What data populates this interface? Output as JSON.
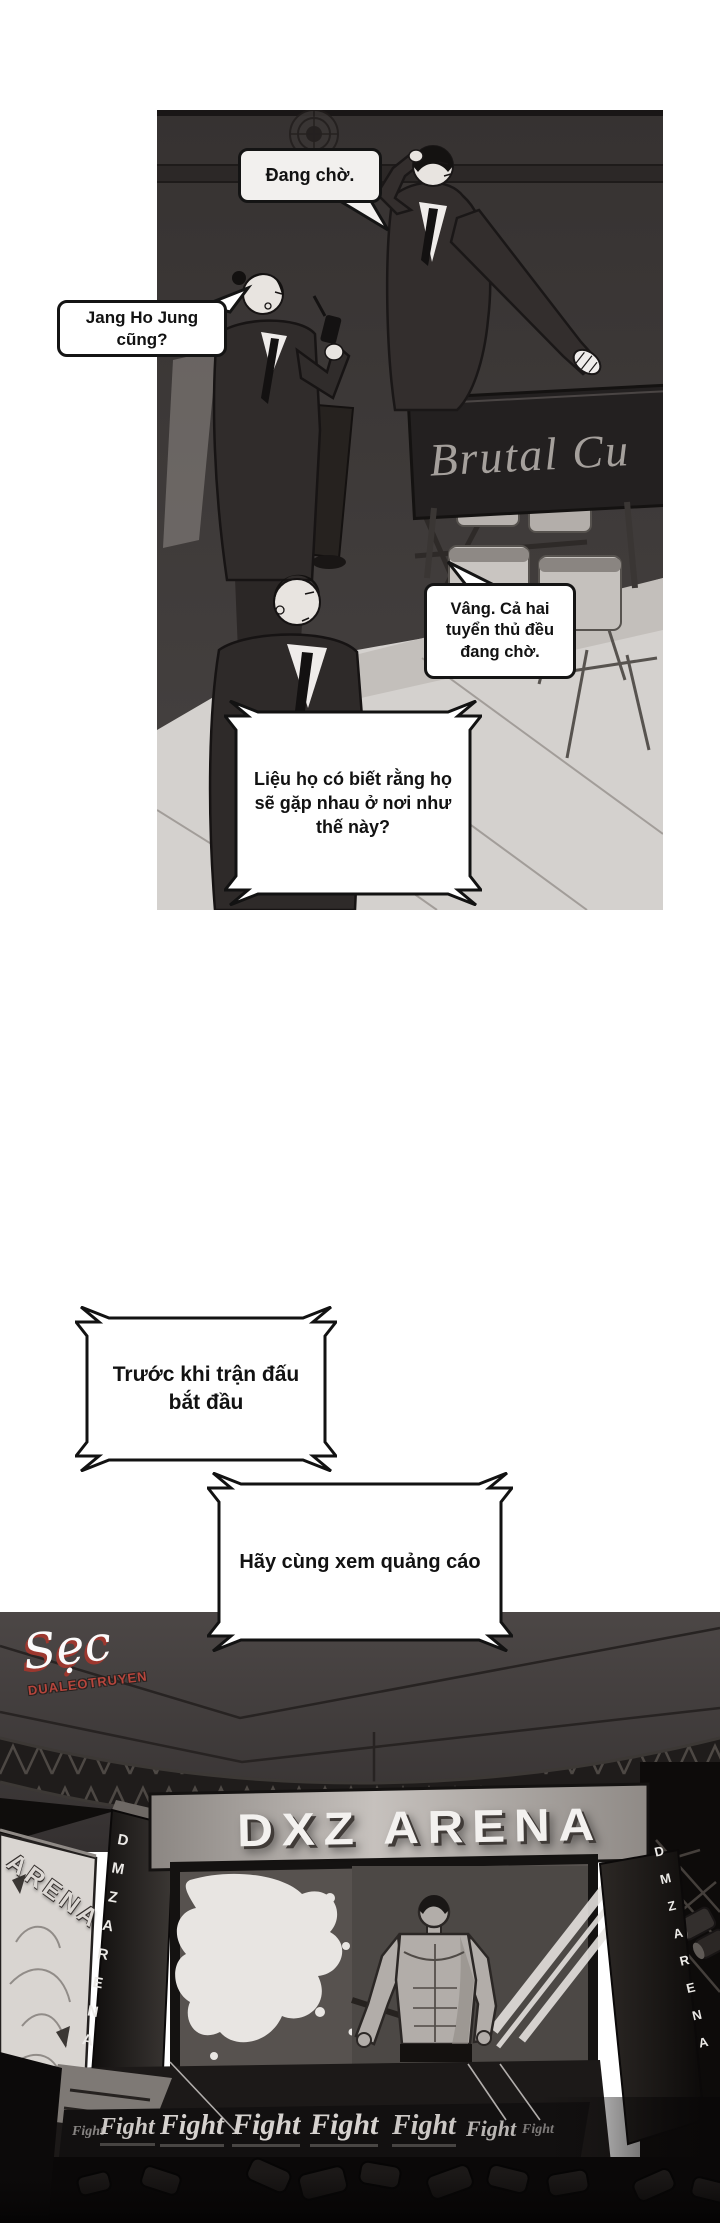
{
  "comic": {
    "panel1": {
      "bubble_waiting": "Đang chờ.",
      "bubble_question": "Jang Ho Jung cũng?",
      "bubble_answer": "Vâng. Cả hai tuyển thủ đều đang chờ.",
      "thought_box": "Liệu họ có biết rằng họ sẽ gặp nhau ở nơi như thế này?",
      "sign_text": "Brutal Cu"
    },
    "narration": {
      "line1": "Trước khi trận đấu bắt đầu",
      "line2": "Hãy cùng xem quảng cáo"
    },
    "watermark": {
      "logo_script": "Sẹc",
      "logo_site": "DUALEOTRUYEN",
      "accent_color": "#b6453c"
    },
    "arena": {
      "jumbotron_title": "DXZ ARENA",
      "left_pillar_text": "DMZARENA",
      "right_pillar_text": "DMZARENA",
      "side_screen_text": "ARENA",
      "fight_banner": [
        "Fight",
        "Fight",
        "Fight",
        "Fight",
        "Fight",
        "Fight",
        "Fight",
        "Fight"
      ]
    }
  }
}
